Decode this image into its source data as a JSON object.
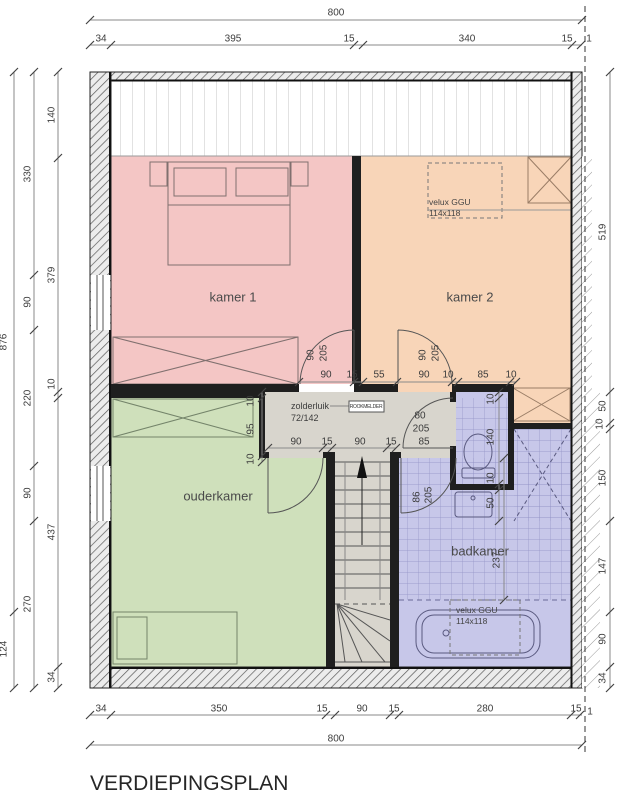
{
  "title": "VERDIEPINGSPLAN",
  "rooms": {
    "kamer1": "kamer 1",
    "kamer2": "kamer 2",
    "ouderkamer": "ouderkamer",
    "badkamer": "badkamer"
  },
  "annotations": {
    "velux_line1": "velux GGU",
    "velux_line2": "114x118",
    "hatch_line1": "zolderluik",
    "hatch_line2": "72/142",
    "smoke_detector": "ROOKMELDER"
  },
  "dims": {
    "top_total": "800",
    "bottom_total": "800",
    "top": [
      "34",
      "395",
      "15",
      "340",
      "15",
      "1"
    ],
    "bottom": [
      "34",
      "350",
      "15",
      "90",
      "15",
      "280",
      "15",
      "1"
    ],
    "left_outer": [
      "876",
      "124"
    ],
    "left_middle": [
      "330",
      "90",
      "220",
      "90",
      "270"
    ],
    "left_inner": [
      "140",
      "379",
      "10",
      "437",
      "34"
    ],
    "right": [
      "519",
      "50",
      "10",
      "150",
      "147",
      "90",
      "34"
    ],
    "hall_top": [
      "90",
      "15",
      "55",
      "90",
      "10",
      "85",
      "10"
    ],
    "hall_bottom": [
      "90",
      "15",
      "90",
      "15"
    ],
    "hall_left": [
      "10",
      "95",
      "10"
    ],
    "nook_right": [
      "10",
      "140",
      "10",
      "50"
    ],
    "bath_height": "237",
    "door_kamer1": [
      "90",
      "205"
    ],
    "door_kamer2": [
      "90",
      "205"
    ],
    "door_toilet": [
      "80",
      "205",
      "85"
    ],
    "door_badkamer": [
      "86",
      "205"
    ]
  },
  "colors": {
    "kamer1": "#f4c6c5",
    "kamer2": "#f8d5b8",
    "ouderkamer": "#cfe0bb",
    "badkamer": "#c7c7e9",
    "hallway": "#d8d5cd"
  }
}
